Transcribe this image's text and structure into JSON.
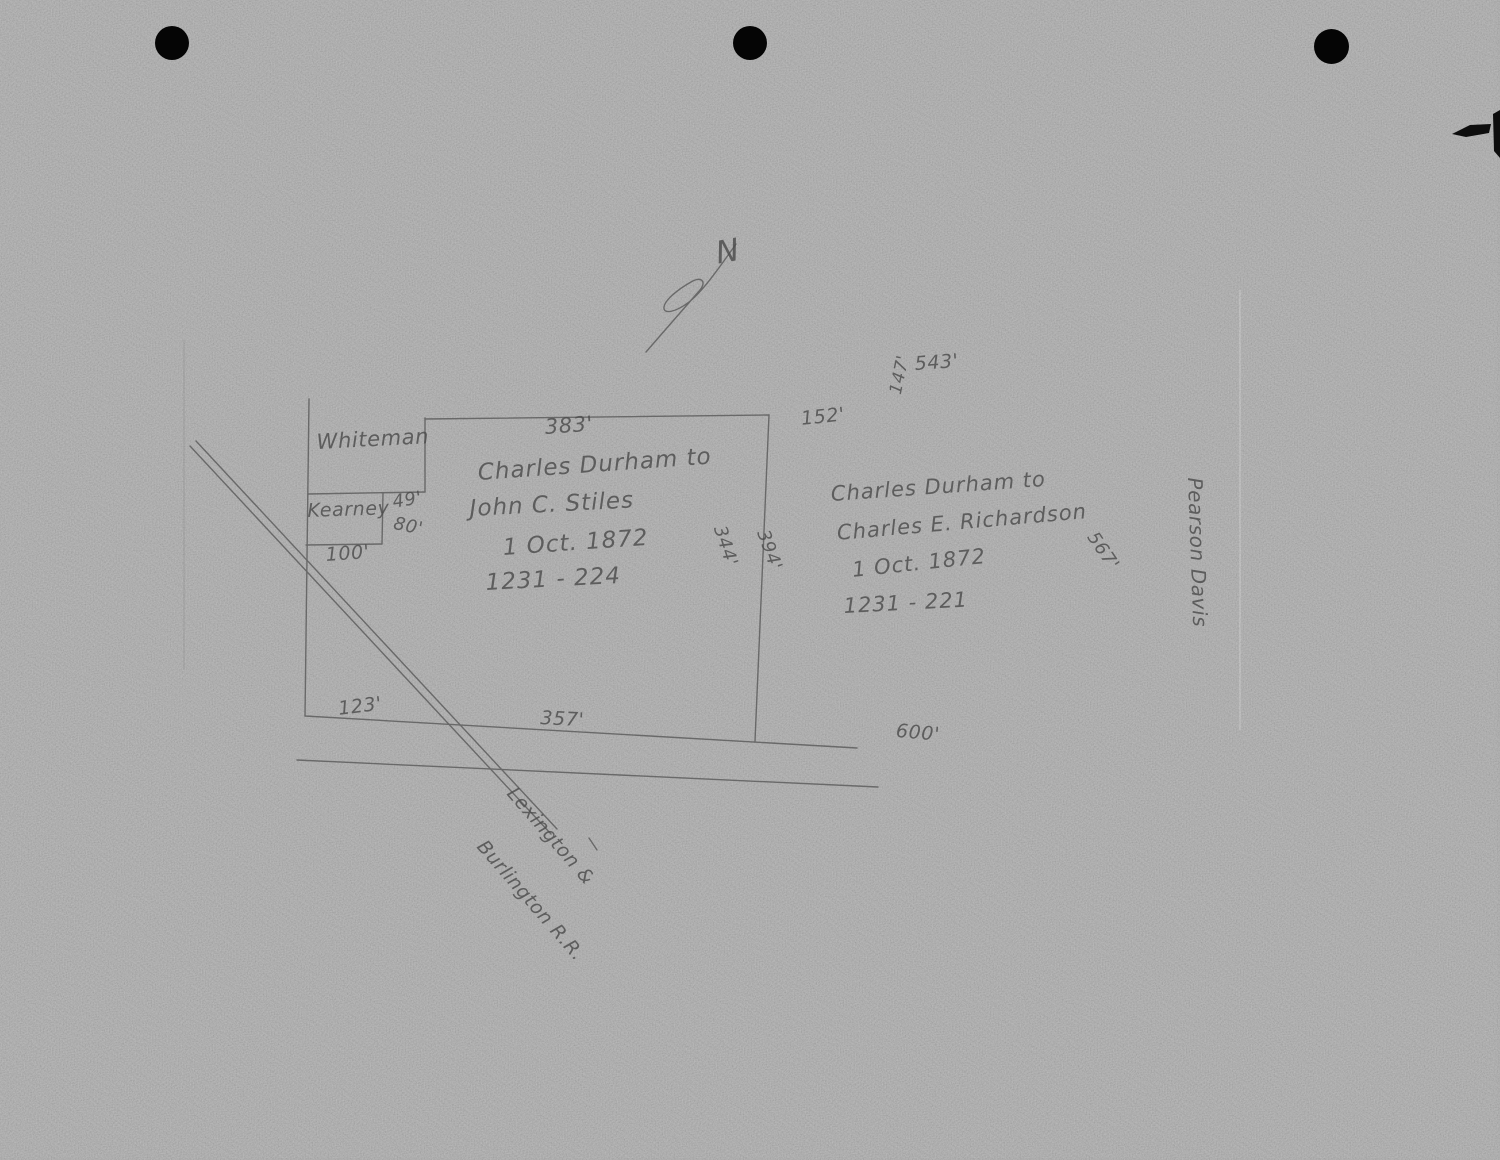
{
  "page": {
    "kind": "Scanned hand-drawn plat sketch (pencil on gray paper)",
    "paper_color": "#a8a8a8",
    "pencil_color": "#4c4c4c",
    "punch_hole_count": 3
  },
  "north_arrow": {
    "label": "N"
  },
  "deeds": {
    "stiles": {
      "grantor_line": "Charles Durham to",
      "grantee_line": "John C. Stiles",
      "date_line": "1 Oct. 1872",
      "book_page": "1231 - 224"
    },
    "richardson": {
      "grantor_line": "Charles Durham to",
      "grantee_line": "Charles E. Richardson",
      "date_line": "1 Oct. 1872",
      "book_page": "1231 - 221"
    }
  },
  "adjacent_owners": {
    "whiteman": "Whiteman",
    "kearney": "Kearney",
    "pearson_davis": "Pearson Davis"
  },
  "railroad": {
    "name_line1": "Lexington &",
    "name_line2": "Burlington R.R."
  },
  "measurements": {
    "north_side": "383'",
    "step_east": "49'",
    "kearney_east": "80'",
    "kearney_south": "100'",
    "west_bottom": "123'",
    "south_side": "357'",
    "south_extension": "600'",
    "upper_right_a": "152'",
    "upper_right_b": "543'",
    "upper_right_c": "147'",
    "east_side_inner": "344'",
    "east_side_outer": "394'",
    "richardson_depth": "567'"
  }
}
